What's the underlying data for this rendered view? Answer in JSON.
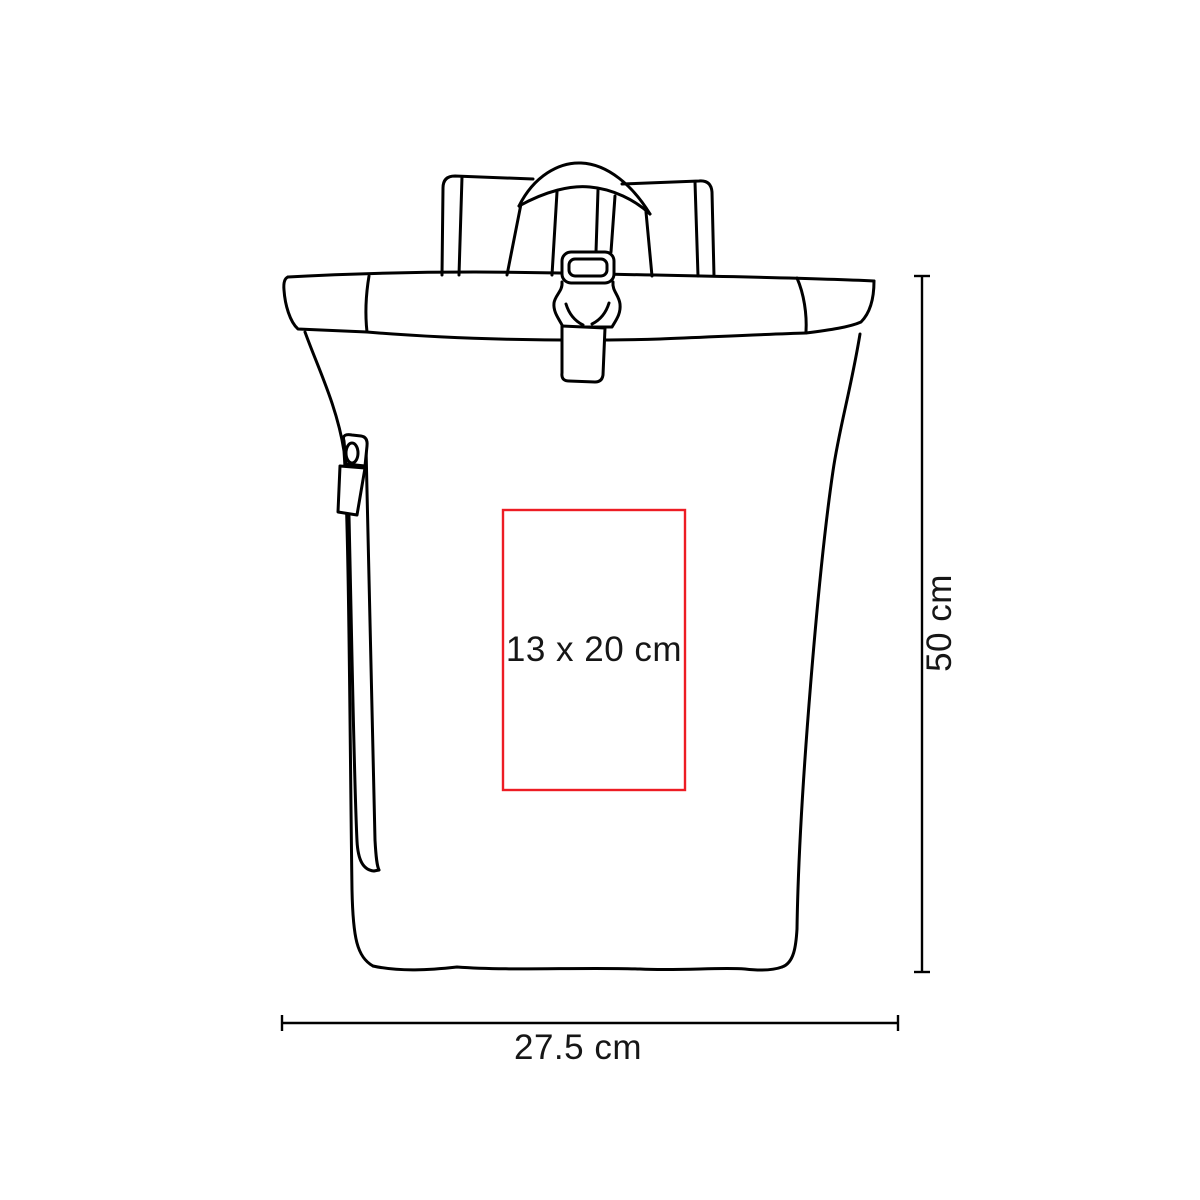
{
  "page": {
    "background_color": "#ffffff"
  },
  "diagram": {
    "type": "product-dimension-diagram",
    "subject": "roll-top-backpack-outline",
    "line_color": "#000000",
    "print_area": {
      "label": "13 x 20 cm",
      "border_color": "#ED1C24"
    },
    "height_dimension": {
      "label": "50 cm"
    },
    "width_dimension": {
      "label": "27.5 cm"
    }
  }
}
